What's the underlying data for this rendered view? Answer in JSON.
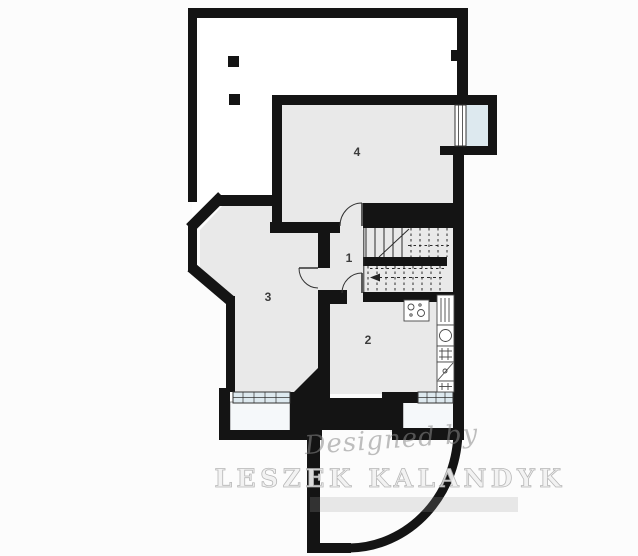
{
  "meta": {
    "kind": "architectural-floor-plan"
  },
  "rooms": [
    {
      "id": "hallway",
      "number": "1"
    },
    {
      "id": "kitchen-room",
      "number": "2"
    },
    {
      "id": "room-three",
      "number": "3"
    },
    {
      "id": "room-four",
      "number": "4"
    }
  ],
  "watermark": {
    "designed_by": "Designed by",
    "author": "LESZEK KALANDYK"
  },
  "colors": {
    "background": "#fcfcfc",
    "wall": "#141414",
    "floor": "#e9e9e9",
    "terrace": "#ffffff",
    "window": "#dde9ef",
    "well": "#f5f8fa",
    "line": "#2a2a2a",
    "door": "#333333",
    "fixture": "#474747",
    "label": "#3c3c3c",
    "watermark_script": "#8a8a8a",
    "watermark_outline": "#b0b0b0"
  }
}
